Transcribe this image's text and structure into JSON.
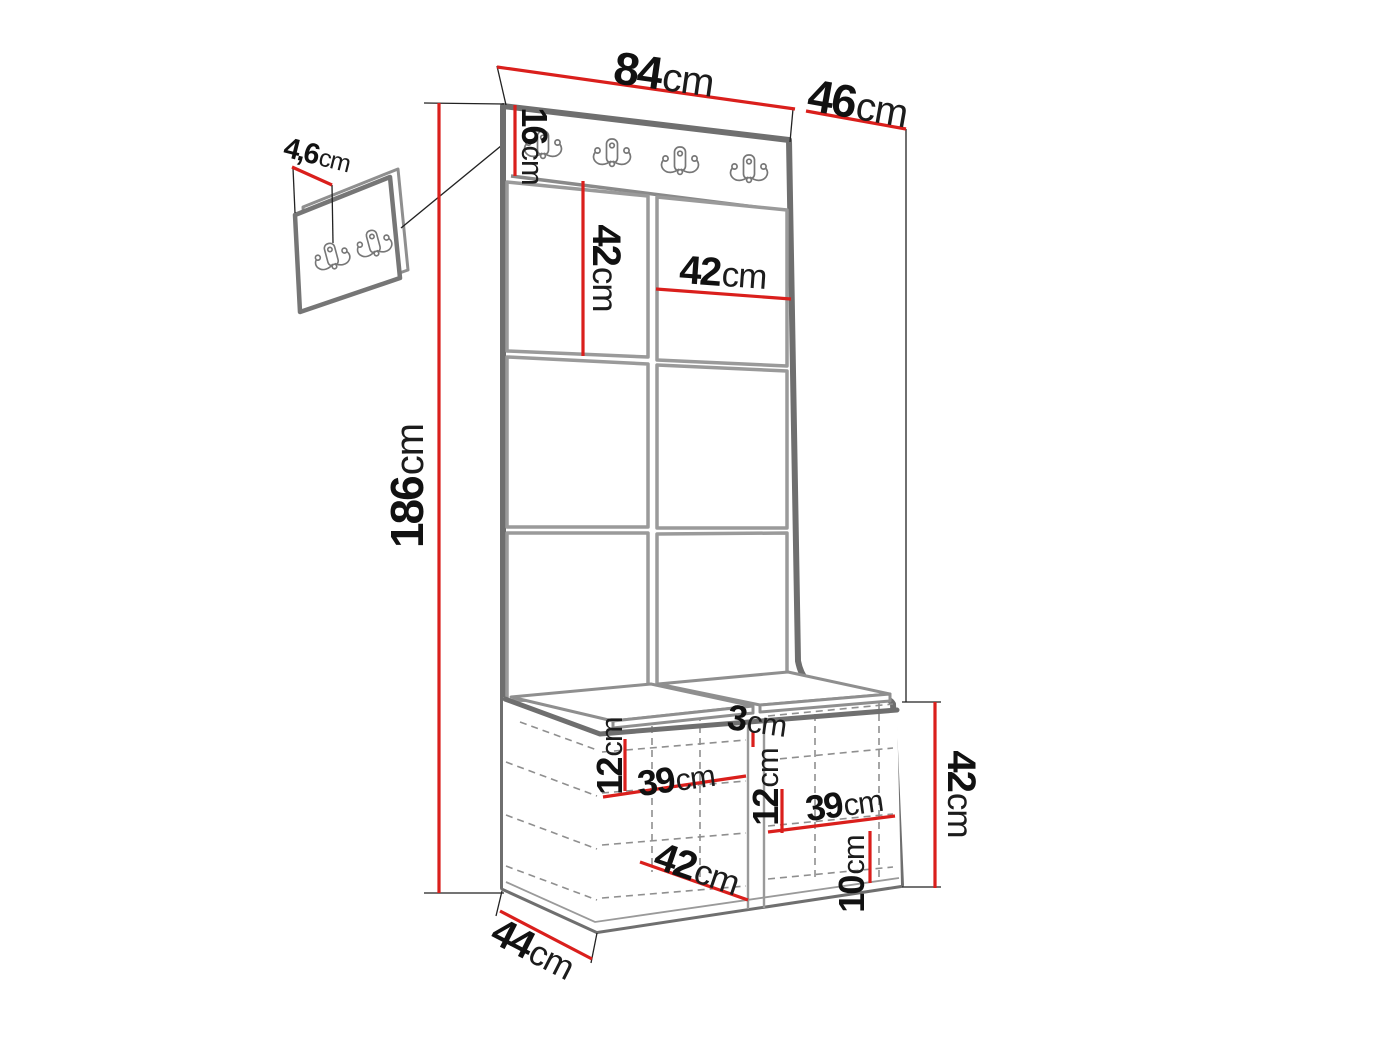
{
  "colors": {
    "dimension_red": "#da1f1c",
    "outline_gray": "#6f6f6f",
    "panel_gray": "#9a9a9a",
    "thin_line_black": "#222222",
    "text_black": "#111111",
    "background": "#ffffff"
  },
  "diagram": {
    "type": "furniture-dimension-drawing",
    "subject": "hallway wardrobe set: coat-hook board, padded wall panels and shoe bench with detail view of hook panel",
    "main_unit": {
      "coat_hook_count": 4,
      "padded_panel_columns": 2,
      "padded_panel_rows": 3
    },
    "detail_view": {
      "coat_hook_count": 2
    }
  },
  "labels": {
    "width_top": {
      "value": "84",
      "unit": "cm"
    },
    "depth_top": {
      "value": "46",
      "unit": "cm"
    },
    "hook_panel_height": {
      "value": "16",
      "unit": "cm"
    },
    "detail_thickness": {
      "value": "4,6",
      "unit": "cm"
    },
    "panel_height": {
      "value": "42",
      "unit": "cm"
    },
    "panel_width": {
      "value": "42",
      "unit": "cm"
    },
    "total_height": {
      "value": "186",
      "unit": "cm"
    },
    "door_gap": {
      "value": "3",
      "unit": "cm"
    },
    "left_top_offset": {
      "value": "12",
      "unit": "cm"
    },
    "left_shelf_width": {
      "value": "39",
      "unit": "cm"
    },
    "mid_top_offset": {
      "value": "12",
      "unit": "cm"
    },
    "right_shelf_width": {
      "value": "39",
      "unit": "cm"
    },
    "bottom_offset": {
      "value": "10",
      "unit": "cm"
    },
    "door_width": {
      "value": "42",
      "unit": "cm"
    },
    "bench_height": {
      "value": "42",
      "unit": "cm"
    },
    "bench_depth": {
      "value": "44",
      "unit": "cm"
    }
  }
}
